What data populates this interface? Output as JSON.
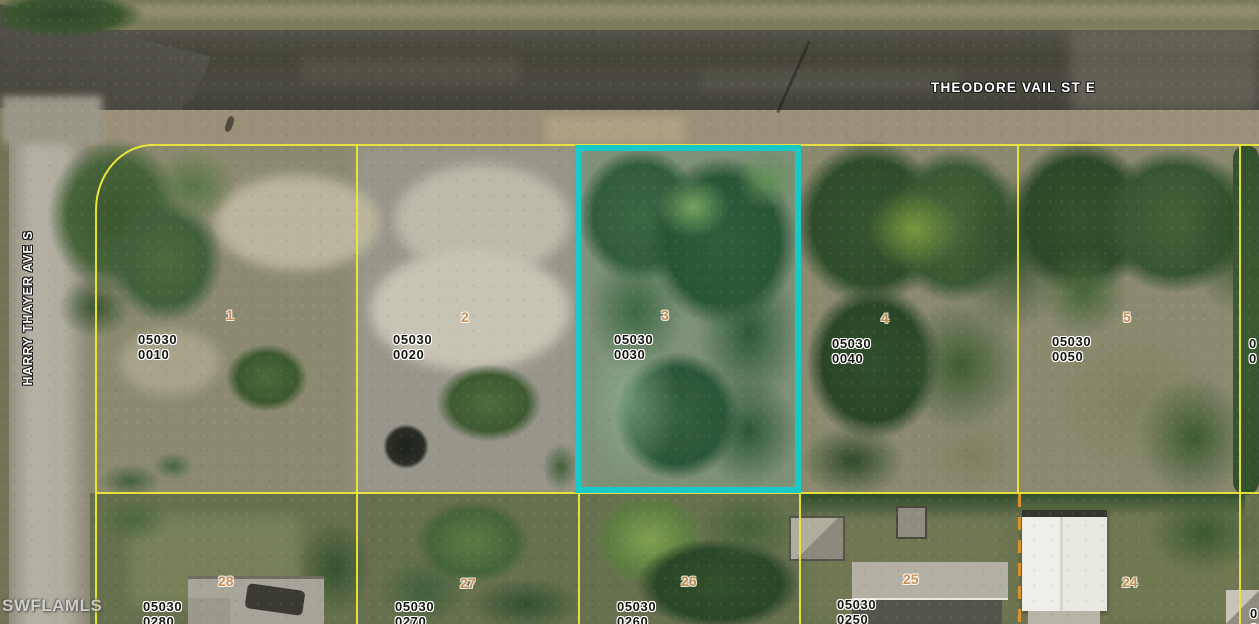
{
  "streets": {
    "top": "THEODORE VAIL ST E",
    "left": "HARRY THAYER AVE S"
  },
  "watermark": "SWFLAMLS",
  "highlight": {
    "lot": "3",
    "outline_color": "#17c9c9"
  },
  "boundary_line_color": "#ece63a",
  "parcels_top": [
    {
      "strap1": "05030",
      "strap2": "0010",
      "lot": "1"
    },
    {
      "strap1": "05030",
      "strap2": "0020",
      "lot": "2"
    },
    {
      "strap1": "05030",
      "strap2": "0030",
      "lot": "3"
    },
    {
      "strap1": "05030",
      "strap2": "0040",
      "lot": "4"
    },
    {
      "strap1": "05030",
      "strap2": "0050",
      "lot": "5"
    }
  ],
  "parcels_bottom": [
    {
      "strap1": "05030",
      "strap2": "0280",
      "lot": "28"
    },
    {
      "strap1": "05030",
      "strap2": "0270",
      "lot": "27"
    },
    {
      "strap1": "05030",
      "strap2": "0260",
      "lot": "26"
    },
    {
      "strap1": "05030",
      "strap2": "0250",
      "lot": "25"
    },
    {
      "lot": "24"
    }
  ],
  "partial_labels": {
    "right_top_l1": "0",
    "right_top_l2": "0",
    "right_bottom_l1": "0",
    "right_bottom_l2": "0"
  }
}
